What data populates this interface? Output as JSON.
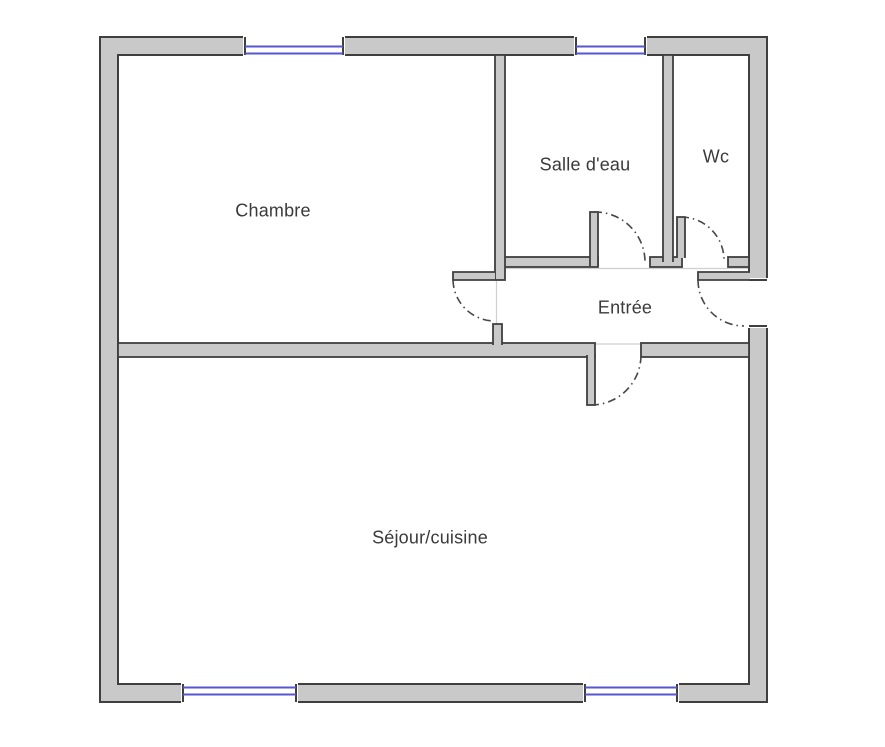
{
  "plan": {
    "type": "floor-plan",
    "language": "fr"
  },
  "rooms": [
    {
      "id": "chambre",
      "label": "Chambre"
    },
    {
      "id": "salle-deau",
      "label": "Salle d'eau"
    },
    {
      "id": "wc",
      "label": "Wc"
    },
    {
      "id": "entree",
      "label": "Entrée"
    },
    {
      "id": "sejour-cuisine",
      "label": "Séjour/cuisine"
    }
  ],
  "features": {
    "windows_top": 2,
    "windows_bottom": 2,
    "interior_doors": 4,
    "entrance_doors": 1
  },
  "colors": {
    "background": "#ffffff",
    "wall_fill": "#c9c9c9",
    "wall_edge": "#3f3f3f",
    "window_line": "#5656d0",
    "door_arc": "#474747",
    "room_boundary_line": "#cfcfcf",
    "text": "#3a3a3a"
  }
}
